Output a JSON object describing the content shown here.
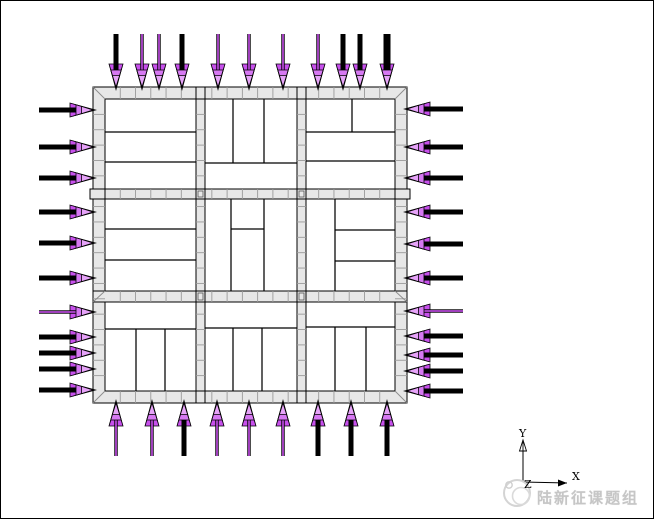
{
  "canvas": {
    "width": 654,
    "height": 519,
    "background": "#ffffff",
    "frame_color": "#000000"
  },
  "colors": {
    "band_fill": "#e7e7e7",
    "band_edge": "#000000",
    "mesh_tick": "#9a9a9a",
    "corner_line": "#8a8a8a",
    "panel_line": "#000000",
    "arrow_black": "#000000",
    "arrow_magenta": "#c750ec",
    "arrow_magenta_mid": "#d678f2",
    "arrow_magenta_light": "#e6a3f8",
    "watermark_gray": "#c6c6c6",
    "logo_gray": "#d4d4d4"
  },
  "plan": {
    "wall_outer": {
      "x": 92,
      "y": 86,
      "w": 314,
      "h": 316
    },
    "wall_inner": {
      "x": 104,
      "y": 98,
      "w": 290,
      "h": 292
    },
    "v_strips": [
      {
        "x": 195,
        "w": 9
      },
      {
        "x": 296,
        "w": 9
      }
    ],
    "h_strips": [
      {
        "y": 188,
        "h": 10
      },
      {
        "y": 290,
        "h": 11
      }
    ],
    "corner_diagonals": [
      [
        92,
        86,
        104,
        98
      ],
      [
        406,
        86,
        394,
        98
      ],
      [
        92,
        402,
        104,
        390
      ],
      [
        406,
        402,
        394,
        390
      ],
      [
        92,
        301,
        104,
        290
      ],
      [
        394,
        290,
        406,
        301
      ]
    ],
    "end_blocks": [
      [
        89,
        188,
        15,
        10
      ],
      [
        394,
        188,
        15,
        10
      ],
      [
        195,
        86,
        9,
        12
      ],
      [
        296,
        86,
        9,
        12
      ],
      [
        195,
        390,
        9,
        12
      ],
      [
        296,
        390,
        9,
        12
      ]
    ],
    "junction_blocks": [
      [
        195,
        188,
        9,
        10
      ],
      [
        296,
        188,
        9,
        10
      ],
      [
        195,
        290,
        9,
        11
      ],
      [
        296,
        290,
        9,
        11
      ]
    ],
    "panel_lines": [
      [
        104,
        131,
        195,
        131
      ],
      [
        104,
        161,
        195,
        161
      ],
      [
        232,
        98,
        232,
        162
      ],
      [
        263,
        98,
        263,
        162
      ],
      [
        204,
        162,
        296,
        162
      ],
      [
        351,
        98,
        351,
        131
      ],
      [
        305,
        131,
        394,
        131
      ],
      [
        305,
        160,
        394,
        160
      ],
      [
        104,
        228,
        195,
        228
      ],
      [
        104,
        259,
        195,
        259
      ],
      [
        230,
        198,
        230,
        290
      ],
      [
        263,
        198,
        263,
        290
      ],
      [
        230,
        228,
        263,
        228
      ],
      [
        334,
        198,
        334,
        290
      ],
      [
        334,
        229,
        394,
        229
      ],
      [
        334,
        260,
        394,
        260
      ],
      [
        104,
        328,
        195,
        328
      ],
      [
        135,
        328,
        135,
        390
      ],
      [
        164,
        328,
        164,
        390
      ],
      [
        204,
        327,
        296,
        327
      ],
      [
        232,
        327,
        232,
        390
      ],
      [
        261,
        327,
        261,
        390
      ],
      [
        305,
        326,
        394,
        326
      ],
      [
        334,
        326,
        334,
        390
      ],
      [
        365,
        326,
        365,
        390
      ]
    ],
    "mesh": {
      "x_start": 104,
      "x_end": 394,
      "y_start": 98,
      "y_end": 390,
      "tick_count": 18
    }
  },
  "loads": {
    "arrow_geom": {
      "black_head_len": 26,
      "black_head_halfw": 7,
      "black_tip_overshoot": 4,
      "magenta_layers": [
        [
          23,
          7
        ],
        [
          17,
          5.2
        ],
        [
          11.5,
          3.6
        ]
      ],
      "shaft_setback": 12,
      "thick_w": 5,
      "xthick_w": 7,
      "thin_outer_w": 3.4,
      "thin_core_w": 1.6
    },
    "edges": [
      {
        "name": "top",
        "orient": "v",
        "tip": 86,
        "tail": 33,
        "sign": 1,
        "arrows": [
          [
            115,
            "thick"
          ],
          [
            141,
            "thin"
          ],
          [
            158,
            "thin"
          ],
          [
            181,
            "thick"
          ],
          [
            217,
            "thin"
          ],
          [
            248,
            "thin"
          ],
          [
            282,
            "thin"
          ],
          [
            317,
            "thin"
          ],
          [
            342,
            "thick"
          ],
          [
            359,
            "thick"
          ],
          [
            386,
            "xthick"
          ]
        ]
      },
      {
        "name": "left",
        "orient": "h",
        "tip": 92,
        "tail": 38,
        "sign": 1,
        "arrows": [
          [
            109,
            "thick"
          ],
          [
            146,
            "thick"
          ],
          [
            177,
            "thick"
          ],
          [
            211,
            "thick"
          ],
          [
            242,
            "thick"
          ],
          [
            277,
            "thick"
          ],
          [
            311,
            "thin"
          ],
          [
            336,
            "thick"
          ],
          [
            352,
            "thick"
          ],
          [
            368,
            "thick"
          ],
          [
            389,
            "thick"
          ]
        ]
      },
      {
        "name": "right",
        "orient": "h",
        "tip": 406,
        "tail": 462,
        "sign": -1,
        "arrows": [
          [
            108,
            "thick"
          ],
          [
            146,
            "thick"
          ],
          [
            177,
            "thick"
          ],
          [
            211,
            "thick"
          ],
          [
            243,
            "thick"
          ],
          [
            277,
            "thick"
          ],
          [
            310,
            "thin"
          ],
          [
            335,
            "thick"
          ],
          [
            354,
            "thick"
          ],
          [
            370,
            "thick"
          ],
          [
            390,
            "thick"
          ]
        ]
      },
      {
        "name": "bottom",
        "orient": "v",
        "tip": 402,
        "tail": 455,
        "sign": -1,
        "arrows": [
          [
            115,
            "thin"
          ],
          [
            151,
            "thin"
          ],
          [
            183,
            "thick"
          ],
          [
            216,
            "thin"
          ],
          [
            248,
            "thin"
          ],
          [
            282,
            "thin"
          ],
          [
            317,
            "thick"
          ],
          [
            350,
            "thick"
          ],
          [
            386,
            "thick"
          ]
        ]
      }
    ]
  },
  "axis_triad": {
    "origin": [
      522,
      481
    ],
    "y_tip": [
      522,
      439
    ],
    "x_tip": [
      566,
      482
    ],
    "labels": {
      "x": "X",
      "y": "Y",
      "z": "Z"
    }
  },
  "watermark": {
    "text": "陆新征课题组"
  }
}
